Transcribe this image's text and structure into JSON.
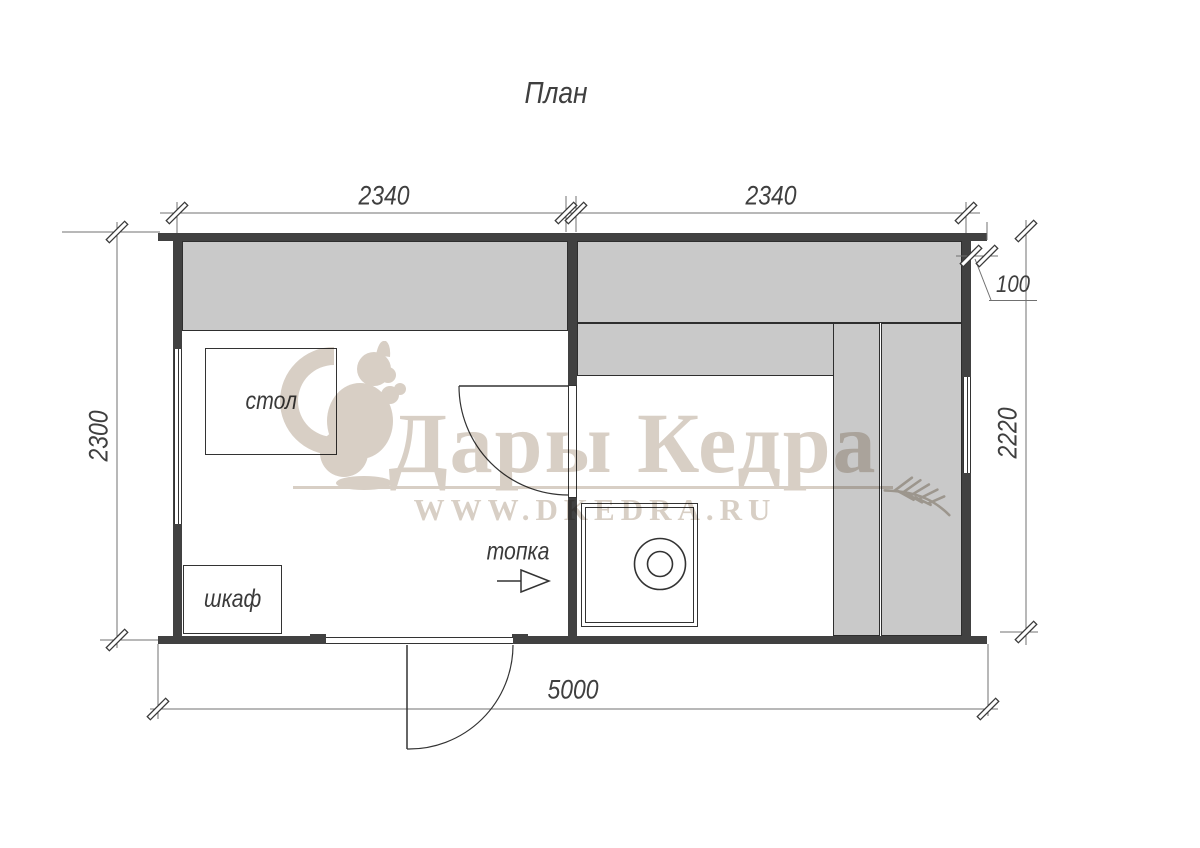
{
  "title": "План",
  "dimensions": {
    "top_left_width": "2340",
    "top_right_width": "2340",
    "right_wall_offset": "100",
    "left_height": "2300",
    "right_inner_height": "2220",
    "total_width": "5000"
  },
  "room_labels": {
    "table": "стол",
    "cabinet": "шкаф",
    "stove_direction": "топка"
  },
  "watermark": {
    "brand": "Дары Кедра",
    "website": "WWW.DKEDRA.RU"
  },
  "colors": {
    "wall": "#414141",
    "bench-fill": "#c9c9c9",
    "line": "#333333",
    "dim-line": "#707070",
    "dim-text": "#3f3f3f",
    "watermark-beige": "#d8cfc5",
    "watermark-branch": "#c6beb3",
    "background": "#ffffff"
  }
}
